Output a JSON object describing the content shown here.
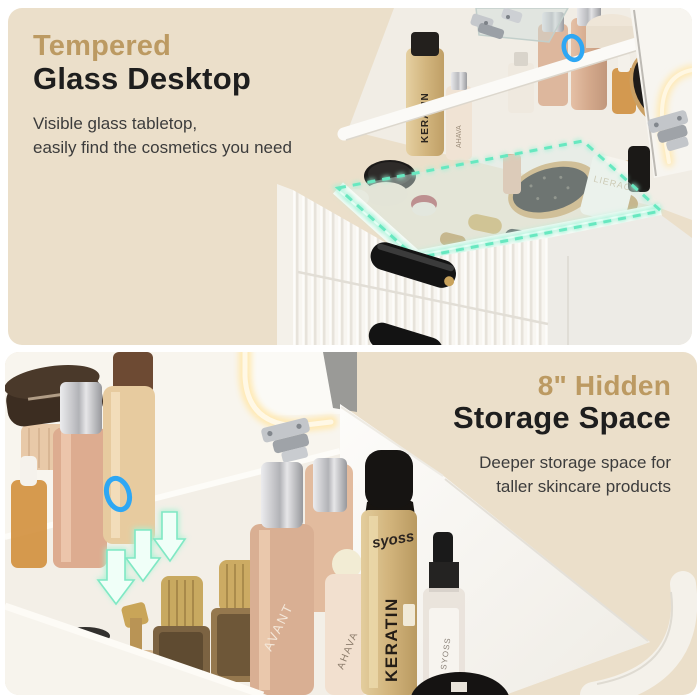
{
  "page": {
    "background": "#ffffff",
    "panel_bg": "#ebdfca"
  },
  "colors": {
    "accent_gold": "#bc9a62",
    "heading_dark": "#1e1e1e",
    "body_text": "#3c3c3c",
    "highlight_teal": "#67e8c0",
    "highlight_blue": "#2ea7f4",
    "led_warm": "#ffedc0"
  },
  "top_panel": {
    "heading_accent": "Tempered",
    "heading_main": "Glass Desktop",
    "body_lines": [
      "Visible glass tabletop,",
      "easily find the cosmetics you need"
    ]
  },
  "bottom_panel": {
    "heading_accent": "8\" Hidden",
    "heading_main": "Storage Space",
    "body_lines": [
      "Deeper storage space for",
      "taller skincare products"
    ]
  },
  "product_labels": {
    "hairspray_brand": "syoss",
    "hairspray_line": "KERATIN",
    "serum_brand": "AHAVA",
    "lotion_brand": "AVANT",
    "spray_label": "SYOSS",
    "tube_brand": "LIERAC"
  }
}
